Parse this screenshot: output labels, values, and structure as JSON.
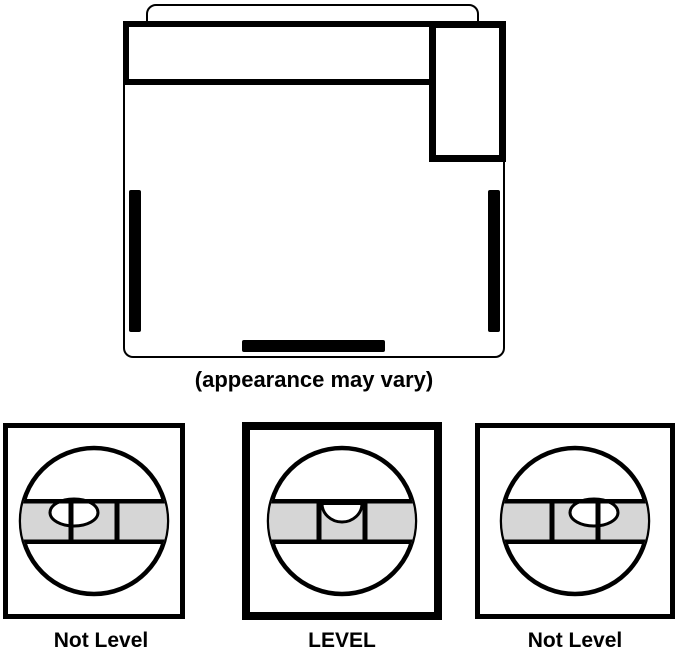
{
  "diagram": {
    "caption": "(appearance may vary)"
  },
  "levels": [
    {
      "label": "Not Level",
      "bubble_position": "left",
      "emphasized": false
    },
    {
      "label": "LEVEL",
      "bubble_position": "center",
      "emphasized": true
    },
    {
      "label": "Not Level",
      "bubble_position": "right",
      "emphasized": false
    }
  ],
  "colors": {
    "line": "#000000",
    "band_fill": "#d6d6d6",
    "background": "#ffffff"
  }
}
